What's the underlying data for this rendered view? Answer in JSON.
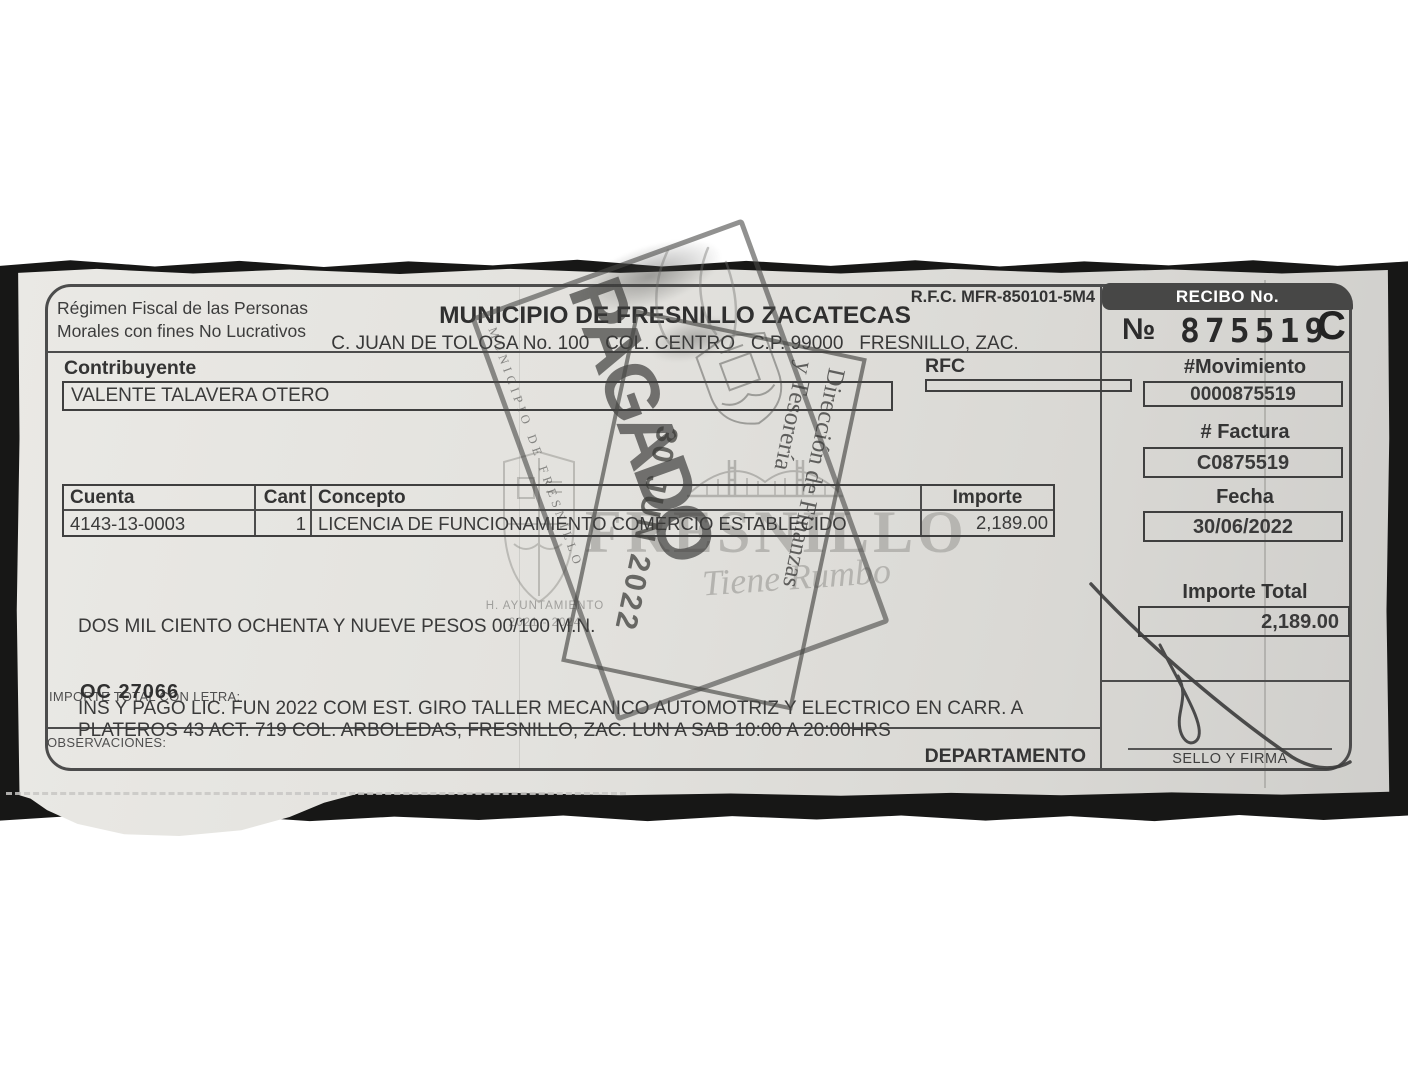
{
  "document": {
    "regimen": {
      "line1": "Régimen Fiscal de las Personas",
      "line2": "Morales con fines No Lucrativos"
    },
    "rfc_header": "R.F.C. MFR-850101-5M4",
    "title": "MUNICIPIO DE FRESNILLO ZACATECAS",
    "address": "C. JUAN DE TOLOSA No. 100   COL. CENTRO   C.P. 99000   FRESNILLO, ZAC.",
    "recibo": {
      "label": "RECIBO No.",
      "numero_symbol": "№",
      "number": "875519",
      "series": "C"
    },
    "contribuyente": {
      "label": "Contribuyente",
      "name": "VALENTE TALAVERA OTERO"
    },
    "rfc_field": {
      "label": "RFC",
      "value": ""
    },
    "movimiento": {
      "label": "#Movimiento",
      "value": "0000875519"
    },
    "factura": {
      "label": "# Factura",
      "value": "C0875519"
    },
    "fecha": {
      "label": "Fecha",
      "value": "30/06/2022"
    },
    "table": {
      "headers": [
        "Cuenta",
        "Cant",
        "Concepto",
        "Importe"
      ],
      "rows": [
        {
          "cuenta": "4143-13-0003",
          "cant": "1",
          "concepto": "LICENCIA DE FUNCIONAMIENTO COMERCIO ESTABLECIDO",
          "importe": "2,189.00"
        }
      ]
    },
    "importe_total": {
      "label": "Importe Total",
      "value": "2,189.00"
    },
    "amount_in_words": "DOS MIL CIENTO OCHENTA Y NUEVE PESOS 00/100 M.N.",
    "importe_letra_label": "IMPORTE TOTAL CON LETRA:",
    "oc_number": "OC 27066",
    "observaciones": {
      "label": "OBSERVACIONES:",
      "line1": "INS Y PAGO LIC. FUN 2022 COM EST. GIRO TALLER MECANICO AUTOMOTRIZ Y ELECTRICO EN CARR. A",
      "line2": "PLATEROS 43 ACT. 719 COL. ARBOLEDAS, FRESNILLO, ZAC. LUN A SAB 10:00 A 20:00HRS"
    },
    "departamento_label": "DEPARTAMENTO",
    "sello_firma_label": "SELLO Y FIRMA"
  },
  "stamps": {
    "pagado": {
      "text": "PAGADO",
      "edge_text": "MUNICIPIO DE FRESNILLO"
    },
    "fecha_pago": {
      "date": "30 JUN 2022",
      "office_line1": "Dirección de Finanzas",
      "office_line2": "y Tesorería"
    }
  },
  "watermark": {
    "brand": "FRESNILLO",
    "tagline": "Tiene Rumbo",
    "ayuntamiento": "H. AYUNTAMIENTO",
    "period": "2021 - 2024"
  },
  "colors": {
    "paper": "#e3e2de",
    "ink": "#3a3a3a",
    "stamp_ink": "#4a4a48",
    "watermark": "#b4b3af",
    "recibo_bar_bg": "#474746",
    "recibo_bar_text": "#ffffff"
  }
}
